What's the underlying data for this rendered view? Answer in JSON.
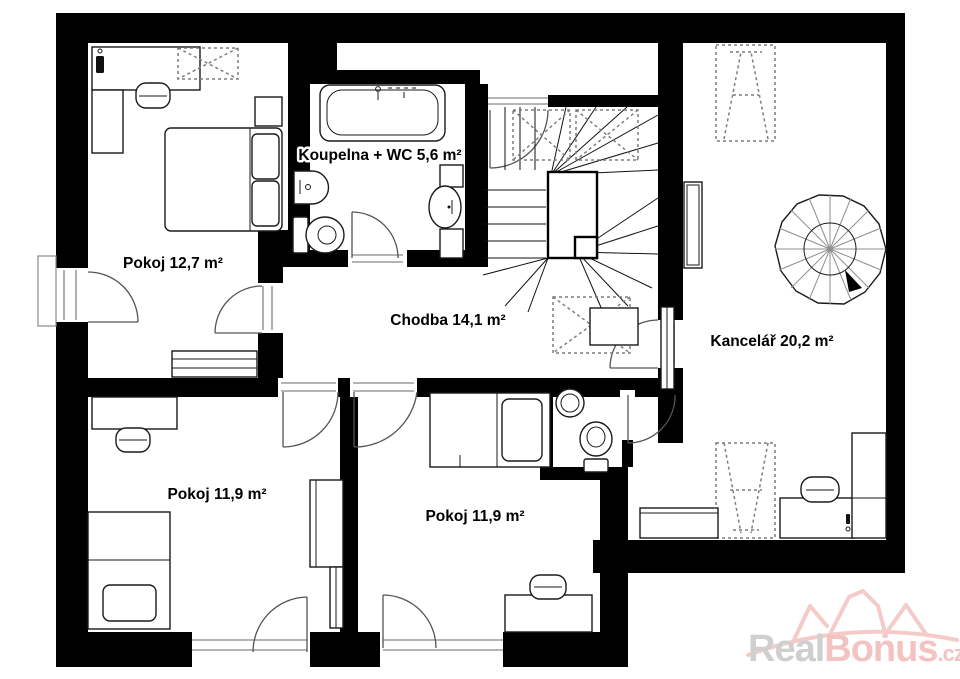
{
  "plan": {
    "rooms": [
      {
        "name": "bedroom-1",
        "label": "Pokoj 12,7 m²"
      },
      {
        "name": "bathroom",
        "label": "Koupelna + WC 5,6 m²"
      },
      {
        "name": "hallway",
        "label": "Chodba 14,1 m²"
      },
      {
        "name": "office",
        "label": "Kancelář 20,2 m²"
      },
      {
        "name": "bedroom-2",
        "label": "Pokoj 11,9 m²"
      },
      {
        "name": "bedroom-3",
        "label": "Pokoj 11,9 m²"
      }
    ]
  },
  "watermark": {
    "part_gray": "Real",
    "part_pink": "Bonus",
    "suffix": ".cz"
  },
  "colors": {
    "walls": "#000000",
    "window": "#9c9c9c",
    "door_arc": "#555555",
    "watermark_gray": "#cfcfcf",
    "watermark_pink": "#f3c3c1",
    "background": "#ffffff"
  }
}
